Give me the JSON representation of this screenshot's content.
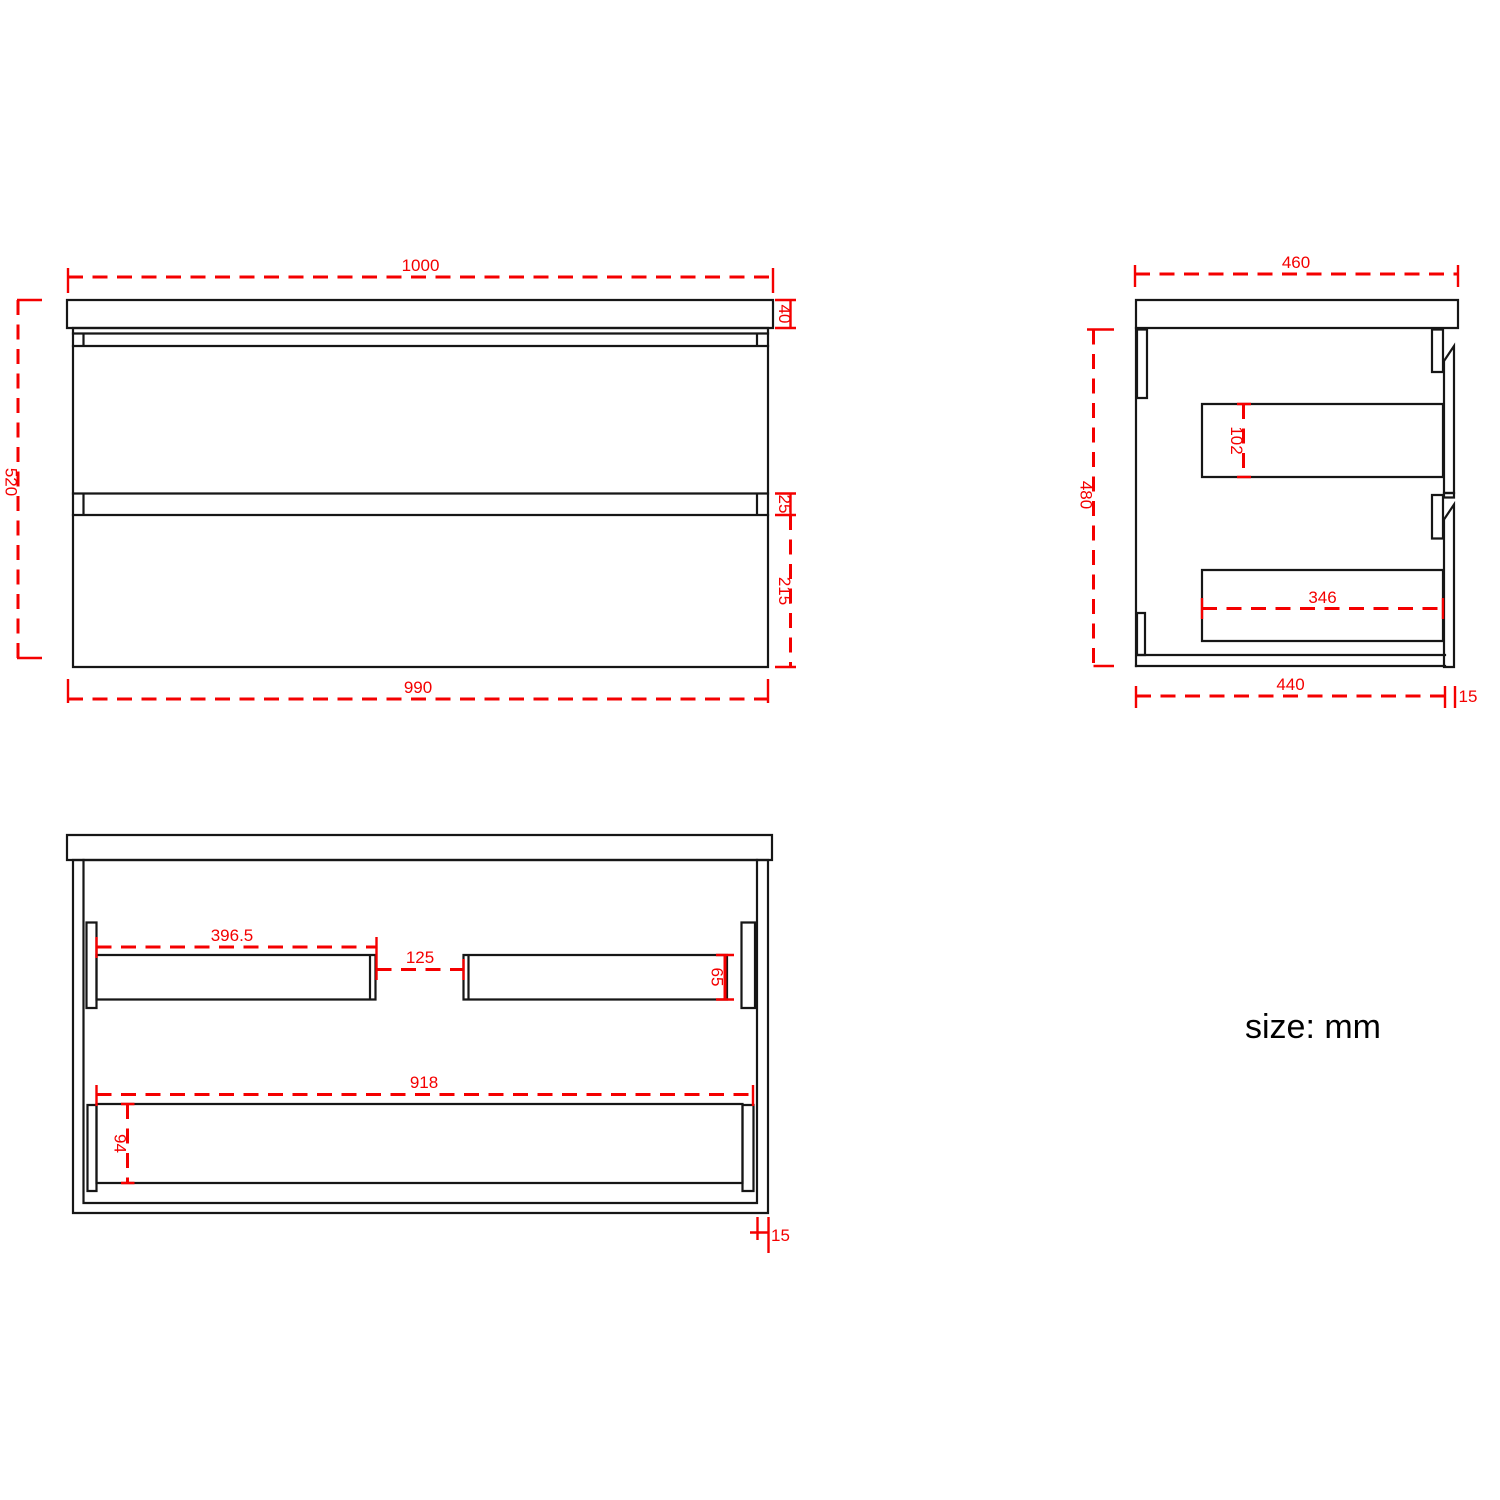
{
  "drawing": {
    "note": "size: mm",
    "front": {
      "top_width": "1000",
      "counter_thk": "40",
      "height": "520",
      "gap": "25",
      "drawer_h": "215",
      "bottom_width": "990"
    },
    "side": {
      "top_depth": "460",
      "height": "480",
      "box_height": "102",
      "box_depth": "346",
      "bottom_depth": "440",
      "panel_thk": "15"
    },
    "plan": {
      "left_back": "396.5",
      "center_gap": "125",
      "back_depth": "65",
      "wide_back": "918",
      "wide_back_depth": "94",
      "panel_thk": "15"
    }
  }
}
